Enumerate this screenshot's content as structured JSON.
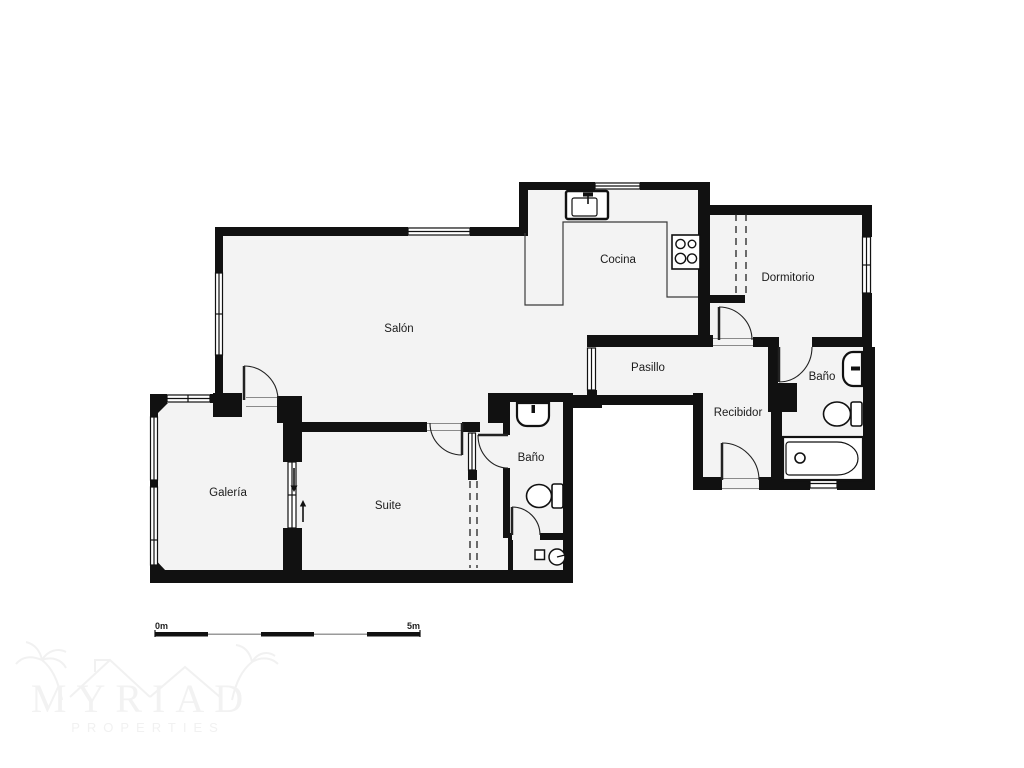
{
  "document": {
    "type": "apartment floor plan",
    "language": "Spanish"
  },
  "rooms": {
    "salon": {
      "label": "Salón"
    },
    "cocina": {
      "label": "Cocina"
    },
    "dormitorio": {
      "label": "Dormitorio"
    },
    "pasillo": {
      "label": "Pasillo"
    },
    "bano_right": {
      "label": "Baño"
    },
    "recibidor": {
      "label": "Recibidor"
    },
    "galeria": {
      "label": "Galería"
    },
    "suite": {
      "label": "Suite"
    },
    "bano_small": {
      "label": "Baño"
    }
  },
  "scale_bar": {
    "start_label": "0m",
    "end_label": "5m",
    "segments": 5
  },
  "watermark": {
    "line1": "MYRIAD",
    "line2": "PROPERTIES"
  },
  "icons": [
    "kitchen-sink-icon",
    "stove-icon",
    "washbasin-icon",
    "toilet-icon",
    "bathtub-icon",
    "washer-icon",
    "sliding-door-arrow-down-icon",
    "sliding-door-arrow-up-icon"
  ],
  "colors": {
    "wall": "#111111",
    "floor": "#f3f3f3",
    "background": "#ffffff",
    "line": "#2f2f2f",
    "threshold": "#888888",
    "watermark": "#f2f2f2"
  }
}
